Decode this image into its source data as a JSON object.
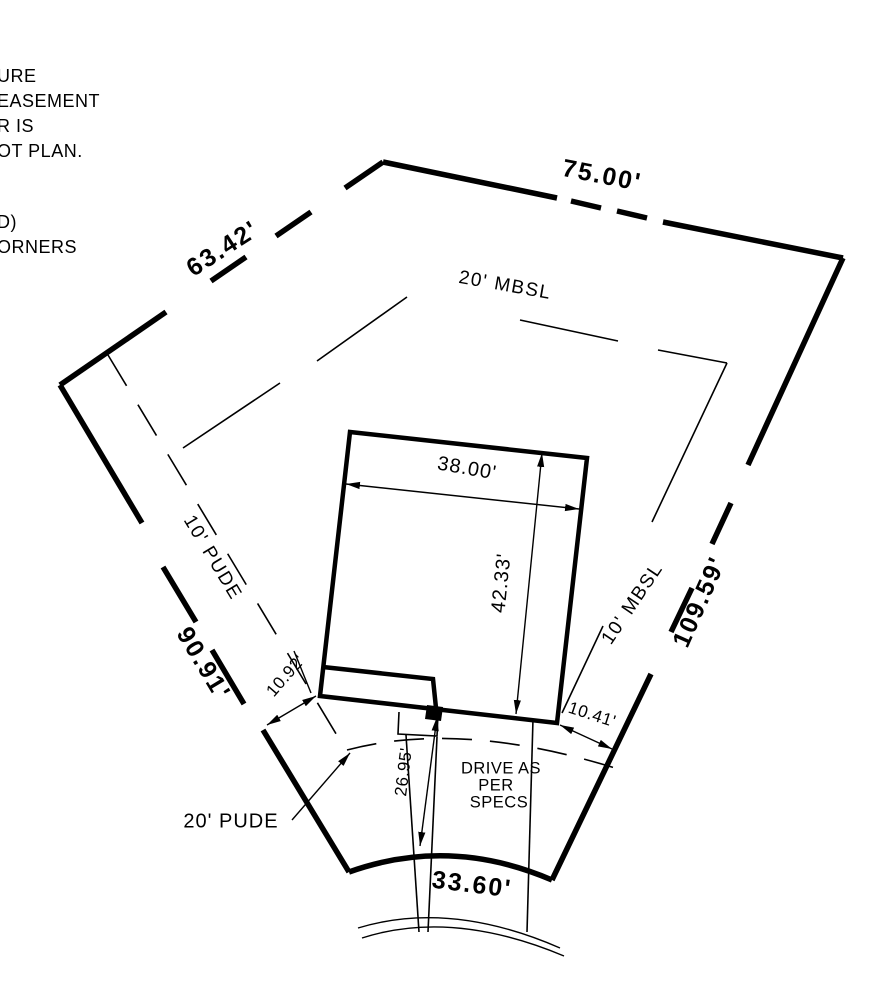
{
  "drawing_title": "residential lot plot plan",
  "colors": {
    "ink": "#000000",
    "paper": "#ffffff"
  },
  "note_fragments": [
    "URE",
    "EASEMENT",
    "R IS",
    "OT PLAN.",
    "D)",
    "ORNERS"
  ],
  "lot_dimensions": {
    "top": "75.00'",
    "upper_left": "63.42'",
    "right": "109.59'",
    "lower_left": "90.91'",
    "front_curve": "33.60'"
  },
  "setbacks": {
    "rear": "20' MBSL",
    "right_side": "10' MBSL",
    "left_side": "10' PUDE",
    "front": "20' PUDE"
  },
  "building": {
    "width": "38.00'",
    "depth": "42.33'"
  },
  "offsets": {
    "left_corner": "10.92'",
    "right_corner": "10.41'",
    "drive_length": "26.95'"
  },
  "drive_note": [
    "DRIVE AS",
    "PER",
    "SPECS"
  ]
}
